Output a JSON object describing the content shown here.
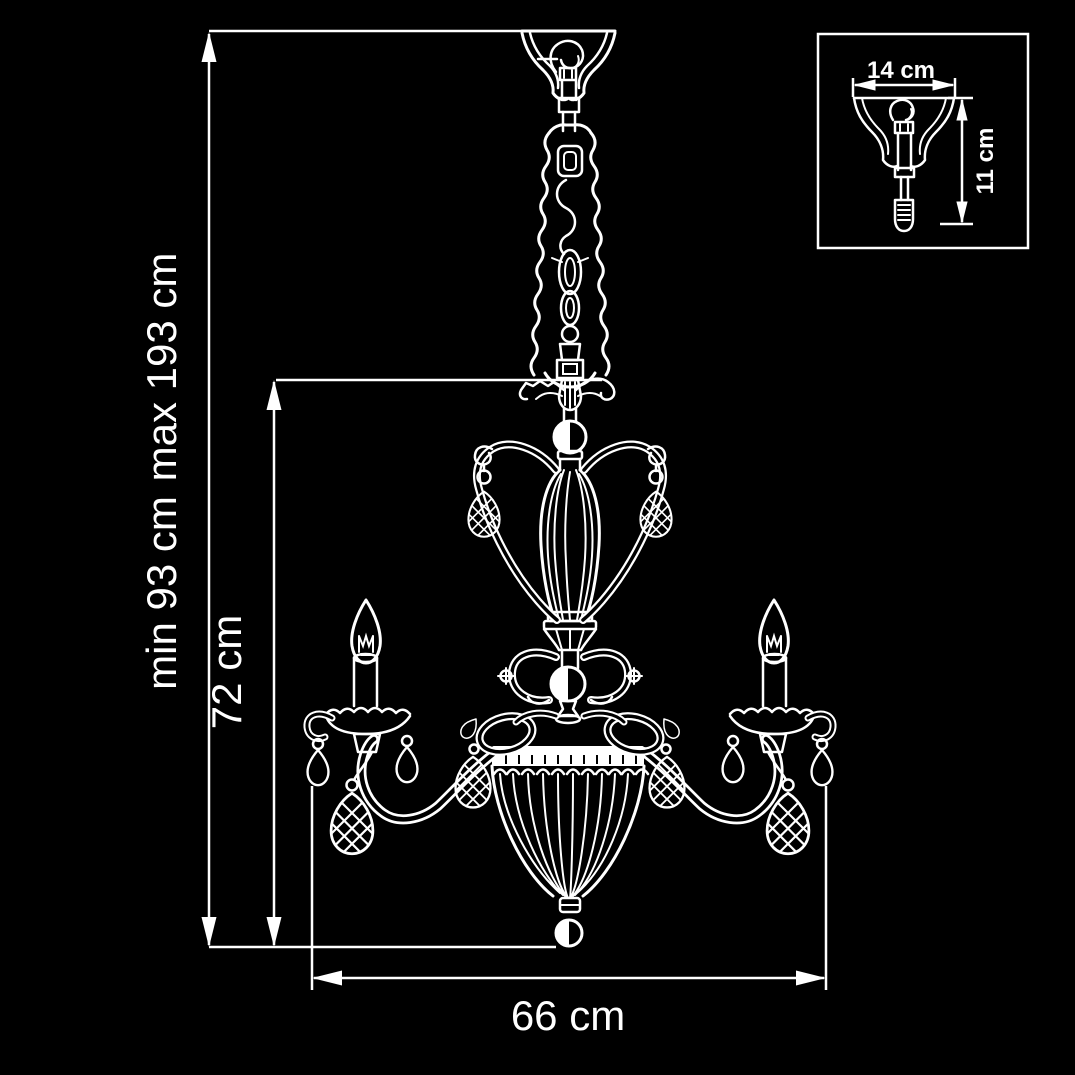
{
  "meta": {
    "background_color": "#000000",
    "line_color": "#ffffff",
    "description": "chandelier technical dimension drawing"
  },
  "dimensions": {
    "overall_height": {
      "min_label": "min 93 cm",
      "max_label": "max 193 cm"
    },
    "body_height_label": "72 cm",
    "body_width_label": "66 cm",
    "canopy_inset": {
      "width_label": "14 cm",
      "height_label": "11 cm"
    }
  }
}
